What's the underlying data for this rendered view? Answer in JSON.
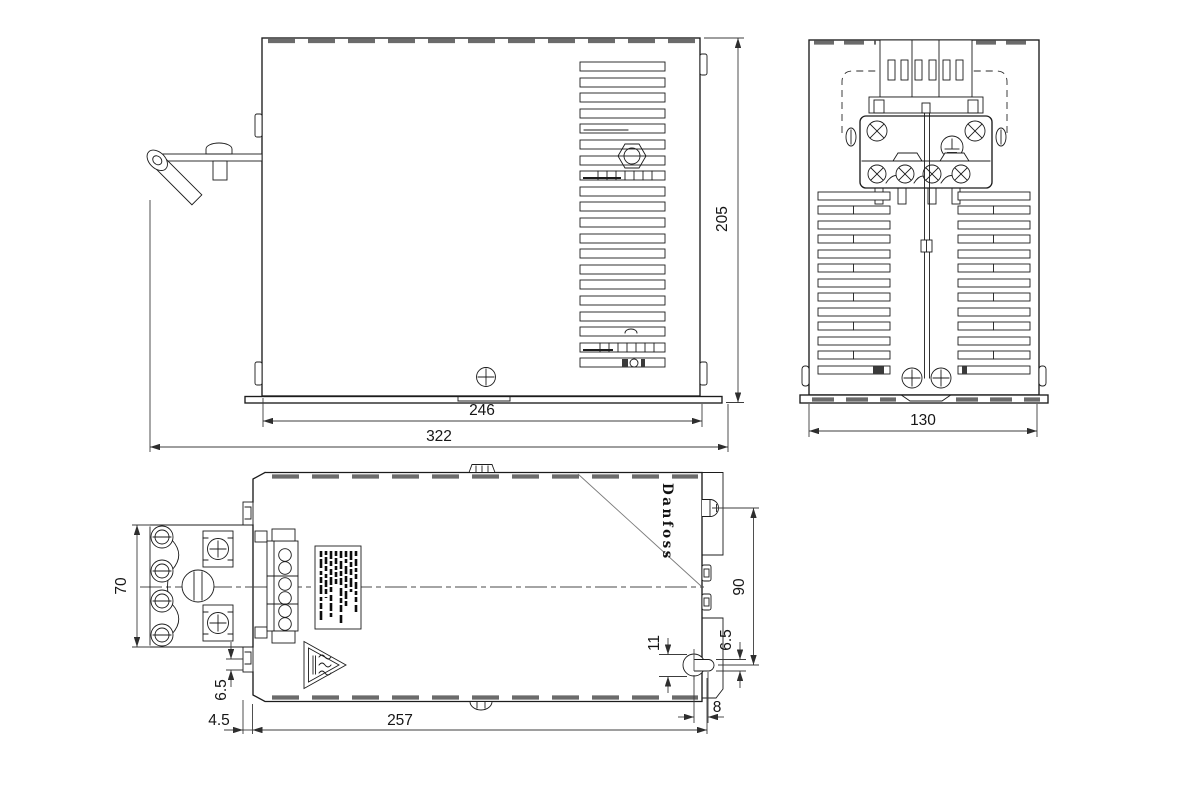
{
  "drawing": {
    "title": "filter-enclosure-dimension-drawing",
    "brand": {
      "logo_text": "Danfoss"
    },
    "dimensions": {
      "front_view": {
        "height": "205",
        "base_width": "246",
        "overall_width": "322"
      },
      "side_view": {
        "overall_width": "130"
      },
      "top_view": {
        "terminal_depth": "70",
        "stud_to_keyhole": "90",
        "keyhole_length": "11",
        "keyhole_offset": "6.5",
        "tab_offset": "6.5",
        "flange_offset": "4.5",
        "body_length": "257",
        "keyhole_end_offset": "8"
      }
    },
    "icons": {
      "hot_surface_warning_icon": "♨",
      "protective_earth_icon": "⏚",
      "phillips_screw_icon": "⊕"
    },
    "colors": {
      "background": "#ffffff",
      "line": "#1c1c1c",
      "dimension_line": "#3c3c3c",
      "vent_dash": "#6b6b6b"
    }
  }
}
